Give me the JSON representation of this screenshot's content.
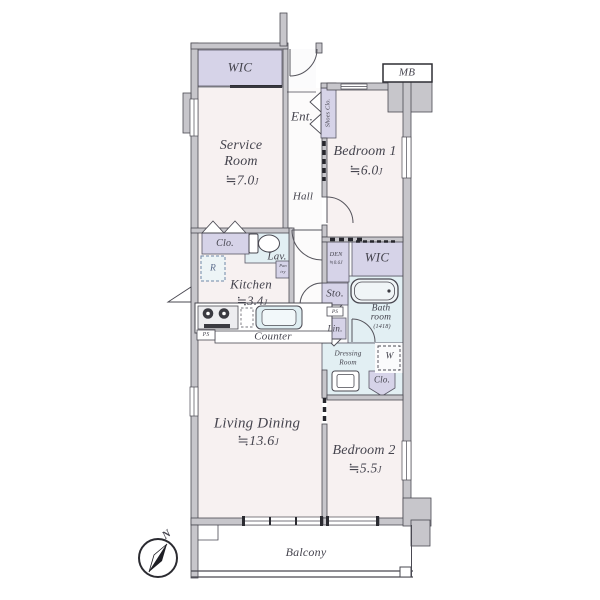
{
  "plan": {
    "wic_top": {
      "label": "WIC"
    },
    "mb": {
      "label": "MB"
    },
    "entrance": {
      "label": "Ent."
    },
    "shoes": {
      "label": "Shoes Clo."
    },
    "service": {
      "line1": "Service",
      "line2": "Room",
      "size": "≒7.0",
      "unit": "J"
    },
    "bedroom1": {
      "label": "Bedroom 1",
      "size": "≒6.0",
      "unit": "J"
    },
    "hall": {
      "label": "Hall"
    },
    "closet1": {
      "label": "Clo."
    },
    "lavatory": {
      "label": "Lav."
    },
    "fridge": {
      "label": "R"
    },
    "kitchen": {
      "label": "Kitchen",
      "size": "≒3.4",
      "unit": "J"
    },
    "pantry": {
      "line1": "Pan",
      "line2": "try"
    },
    "counter": {
      "label": "Counter"
    },
    "ps1": {
      "label": "PS"
    },
    "den": {
      "label": "DEN",
      "size": "≒0.6J"
    },
    "wic2": {
      "label": "WIC"
    },
    "storage": {
      "label": "Sto."
    },
    "bath": {
      "line1": "Bath",
      "line2": "room",
      "size": "(1418)"
    },
    "ps2": {
      "label": "PS"
    },
    "linen": {
      "label": "Lin."
    },
    "dressing": {
      "line1": "Dressing",
      "line2": "Room"
    },
    "washer": {
      "label": "W"
    },
    "closet2": {
      "label": "Clo."
    },
    "living": {
      "label": "Living Dining",
      "size": "≒13.6",
      "unit": "J"
    },
    "bedroom2": {
      "label": "Bedroom 2",
      "size": "≒5.5",
      "unit": "J"
    },
    "balcony": {
      "label": "Balcony"
    },
    "compass": {
      "label": "N"
    }
  },
  "colors": {
    "wall": "#c7c6cb",
    "wall_stroke": "#4a4952",
    "room_floor": "#f7f1f1",
    "storage_fill": "#d6d3e8",
    "wet_fill": "#e2eff3",
    "text": "#45444e"
  }
}
